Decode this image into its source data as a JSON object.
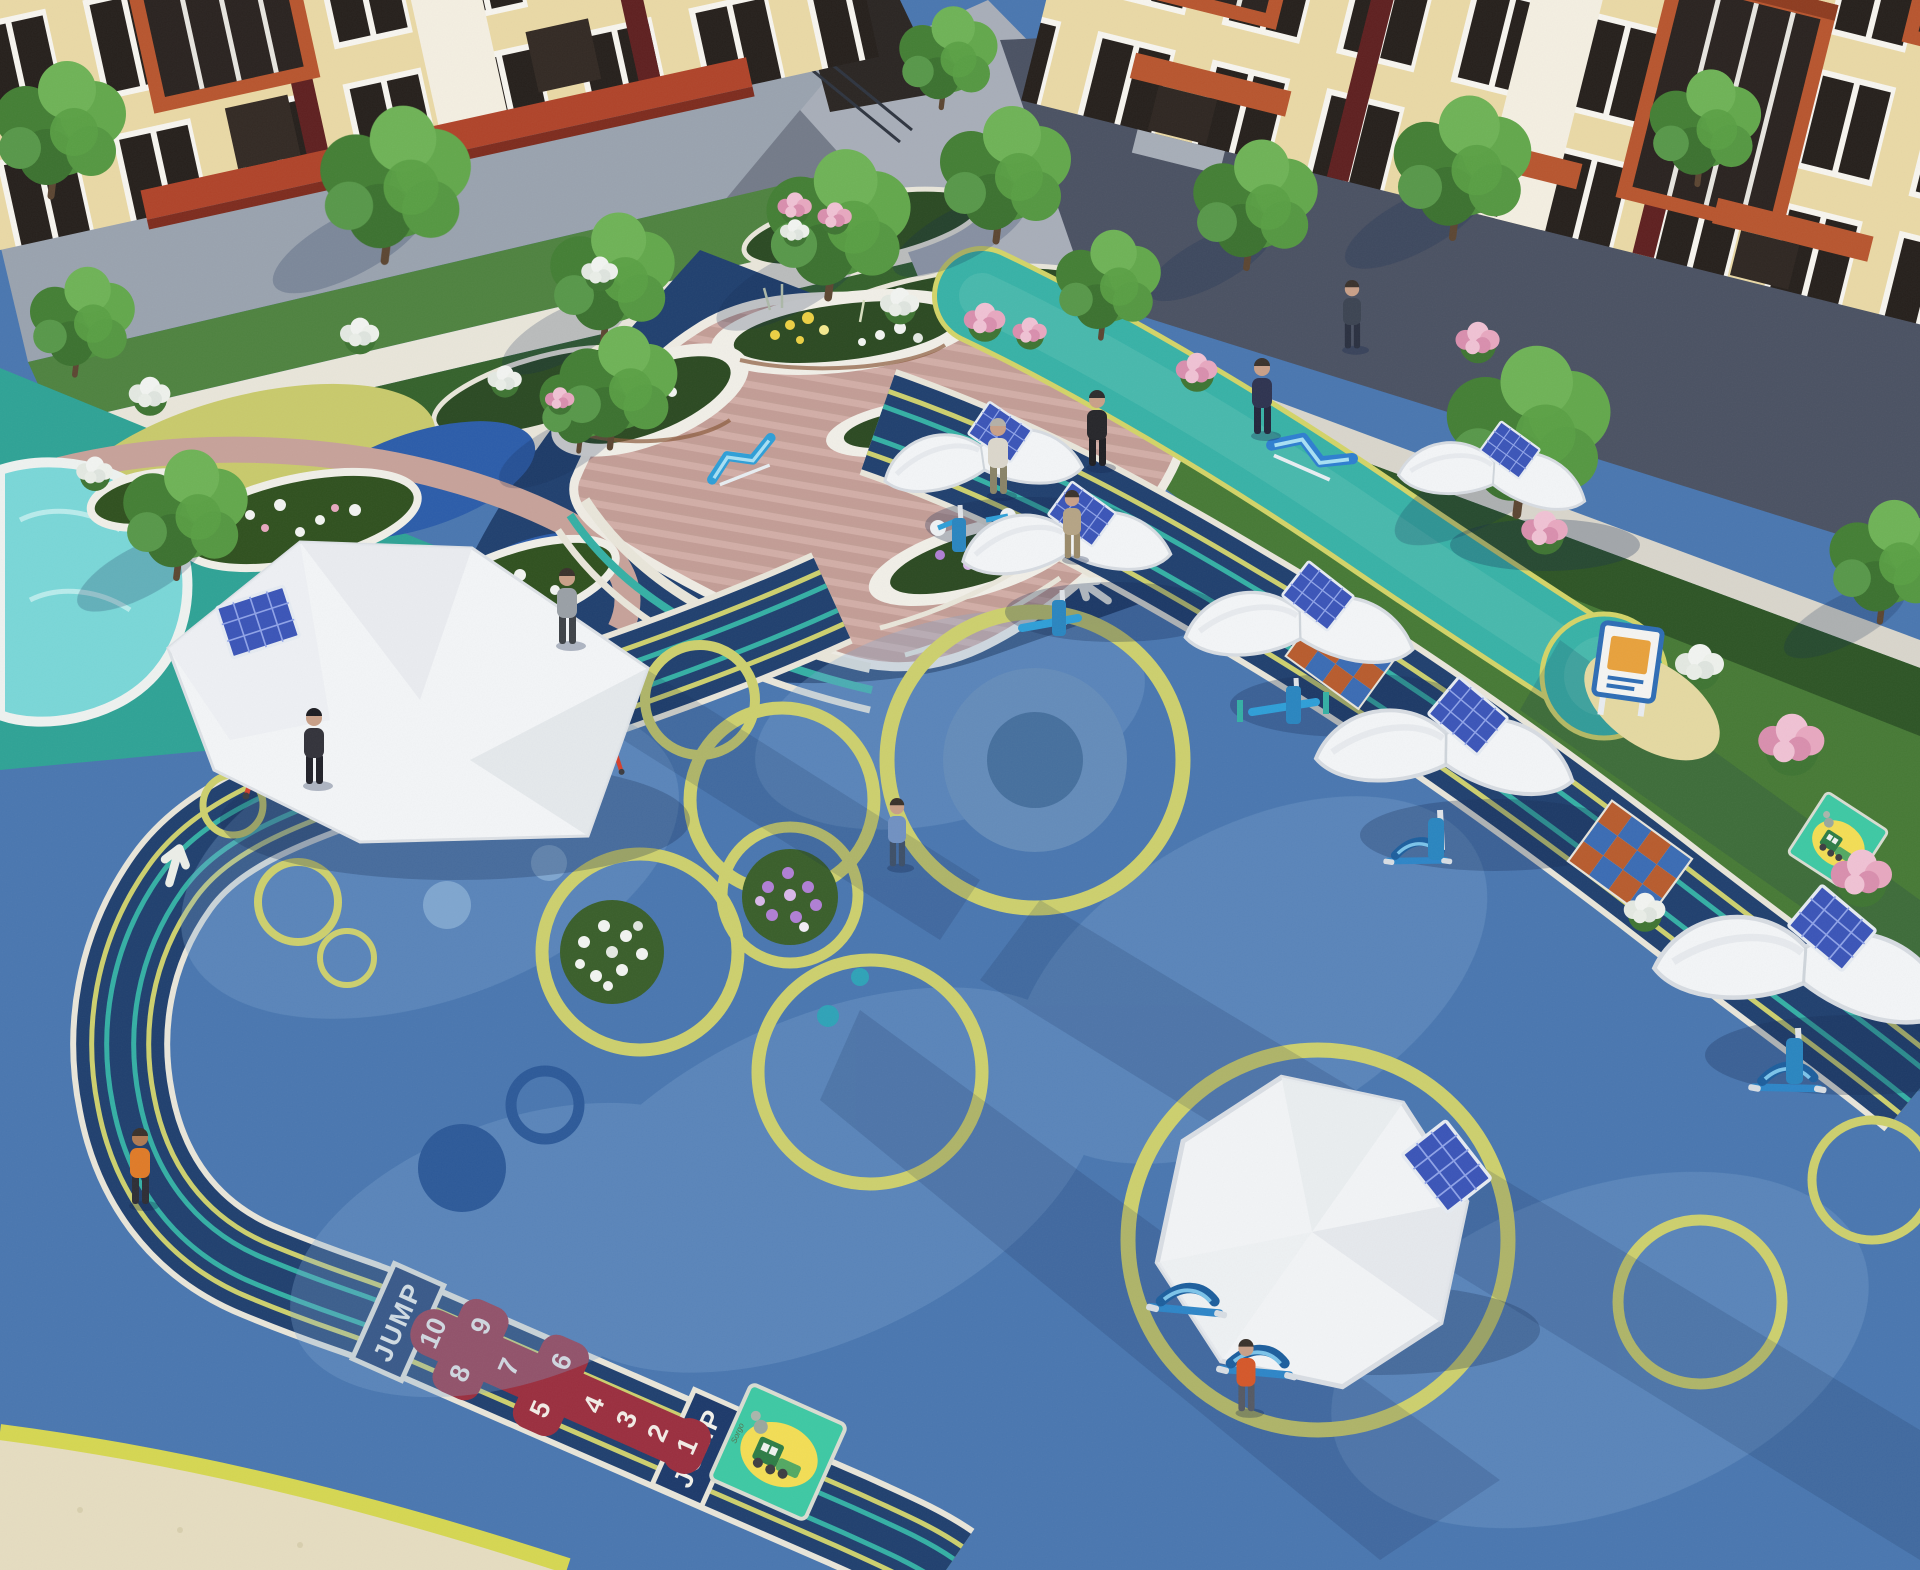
{
  "scene": {
    "description": "Aerial 3D render of an apartment-courtyard fitness playground with solar shade canopies",
    "setting": "residential courtyard",
    "time_of_day": "daytime"
  },
  "markings": {
    "jump_label": "JUMP",
    "hopscotch_numbers": [
      "10",
      "9",
      "8",
      "7",
      "6",
      "5",
      "4",
      "3",
      "2",
      "1"
    ],
    "sign_signature": "Sorgo"
  },
  "inventory": {
    "buildings": 2,
    "shade_structures": 8,
    "solar_panels": 9,
    "people": 10,
    "red_exercise_stations": 5,
    "blue_exercise_stations": 6,
    "train_signs": 2,
    "jump_lane_boxes": 2,
    "hopscotch_games": 1,
    "pools": 1,
    "checker_crossings": 2
  },
  "palette": {
    "surface_blue": "#4a77b0",
    "surface_blue_light": "#7fa8d2",
    "track_navy": "#20406f",
    "ring_yellow": "#cdd06e",
    "stripe_teal": "#35b0a5",
    "strip_teal": "#38b2a7",
    "play_teal": "#2fa396",
    "play_yellow": "#c9ca6c",
    "play_blue": "#2c5daa",
    "hopscotch_red": "#9b2f3f",
    "canopy_white": "#f3f5f7",
    "solar_blue": "#3b55b8",
    "equipment_red": "#d4402e",
    "equipment_blue": "#2f9fd8",
    "deck_wood": "#cfa9a2",
    "planter_white": "#f1efe8",
    "lawn_green": "#4f8340",
    "lawn_dark": "#2e5526",
    "water": "#7ad7d8",
    "sand": "#e6ddc1",
    "curb_yellow": "#d6d752",
    "building_wall": "#ead9a6",
    "building_accent": "#b8562f",
    "building_maroon": "#5f2020",
    "road_gray": "#9aa3af",
    "road_shadow": "#4b5263",
    "checker_orange": "#b85c2e",
    "checker_blue": "#3b6cb4"
  }
}
